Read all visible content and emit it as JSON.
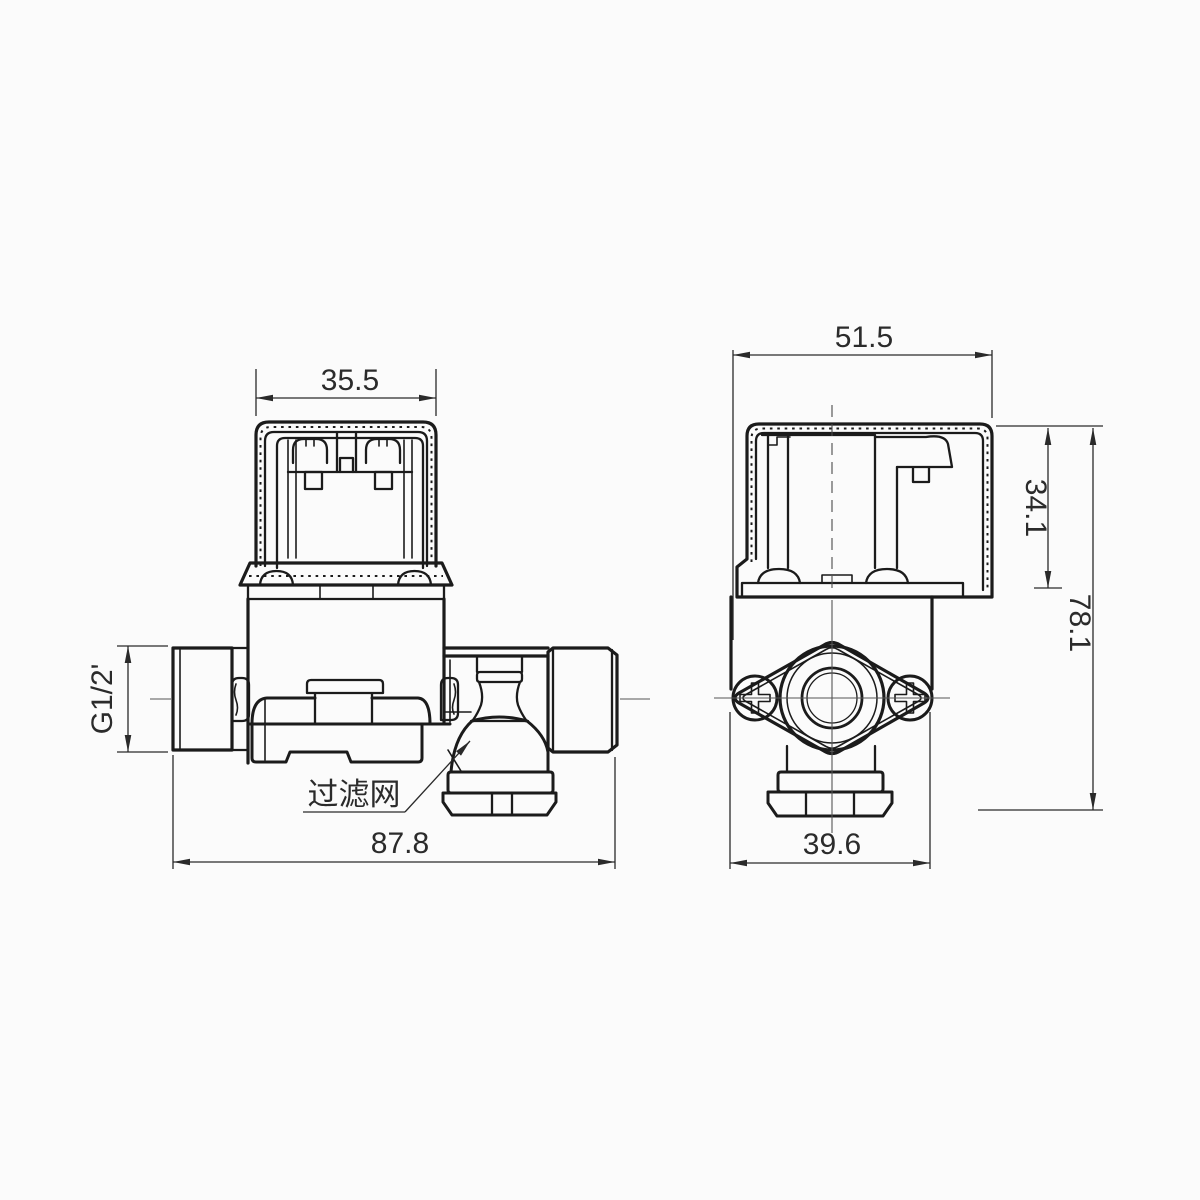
{
  "drawing": {
    "palette": {
      "background": "#fbfbfb",
      "outline": "#1b1b1b",
      "dimension": "#2a2a2a",
      "centerline": "#555555"
    },
    "views": {
      "front": {
        "dims": {
          "coil_width": "35.5",
          "inlet_thread": "G1/2'",
          "overall_length": "87.8"
        },
        "callouts": {
          "filter": "过滤网"
        }
      },
      "side": {
        "dims": {
          "coil_width": "51.5",
          "coil_height": "34.1",
          "overall_height": "78.1",
          "flange_width": "39.6"
        }
      }
    }
  }
}
